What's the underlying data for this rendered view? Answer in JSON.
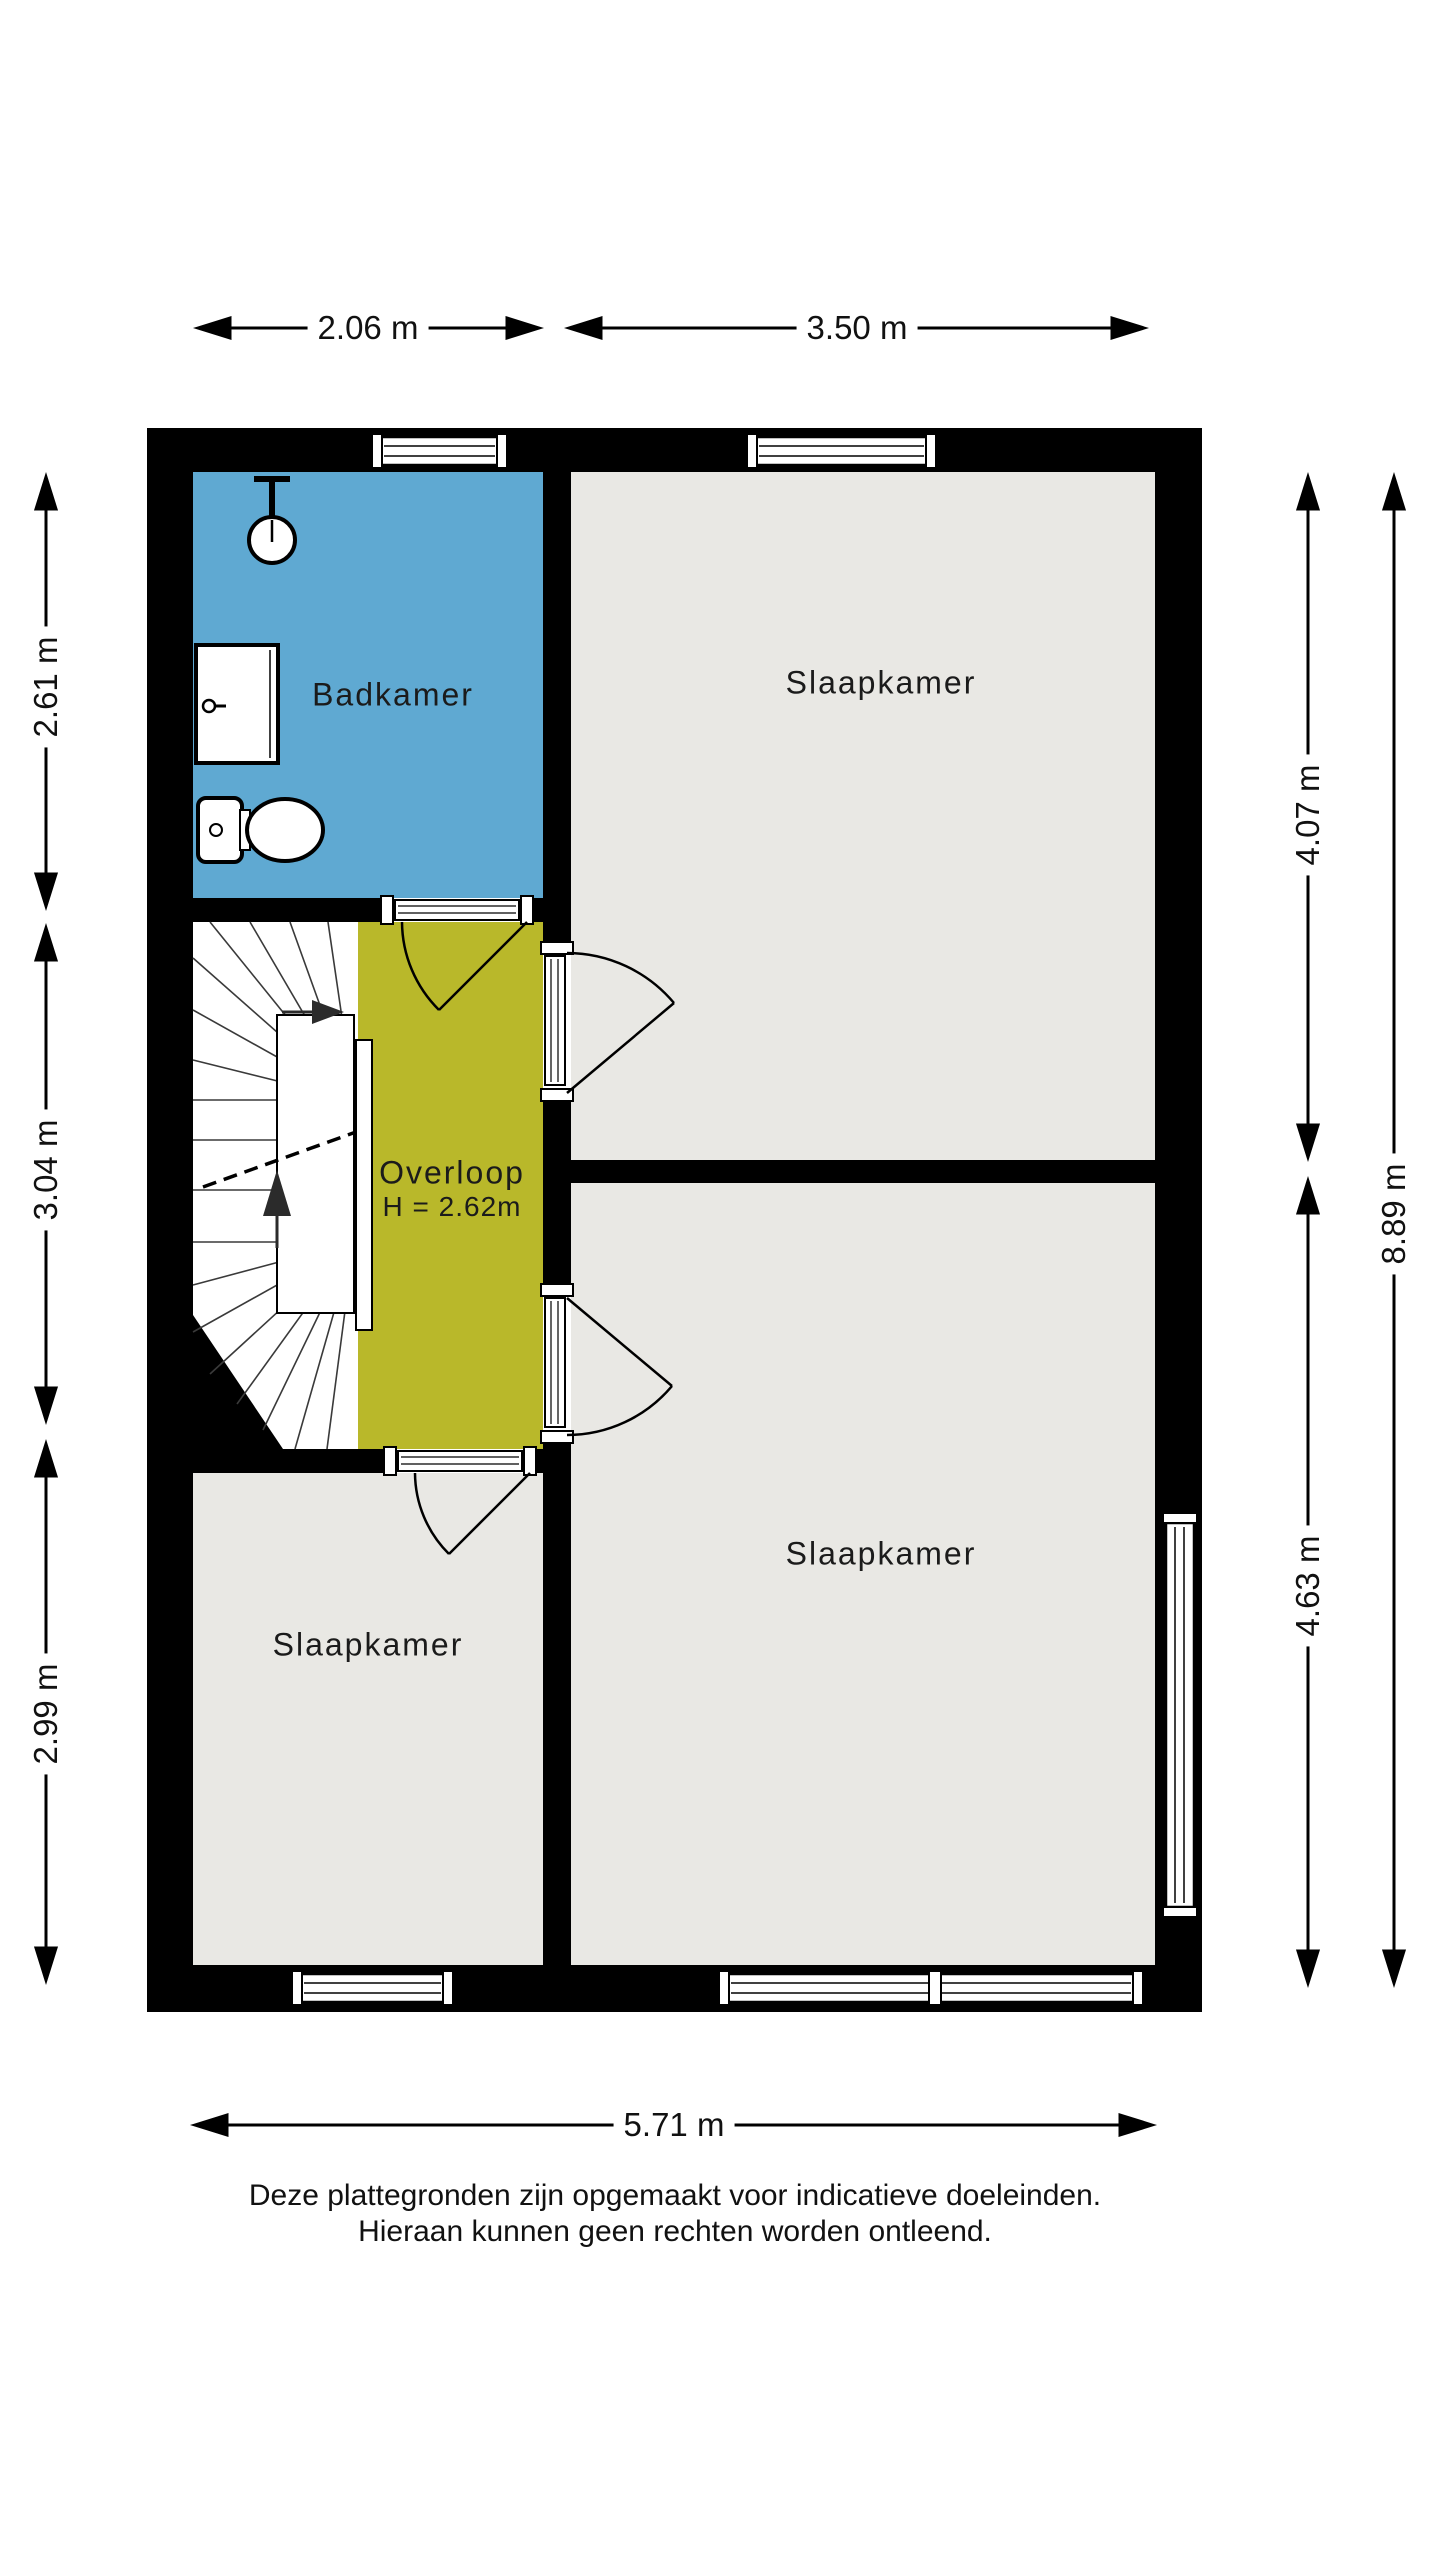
{
  "colors": {
    "wall": "#000000",
    "bathroom_floor": "#5FA9D2",
    "landing_floor": "#B9B82A",
    "room_floor": "#E9E8E4",
    "background": "#FFFFFF",
    "tread_line": "#3a3a3a"
  },
  "rooms": {
    "badkamer": {
      "label": "Badkamer"
    },
    "slaapkamer_top_right": {
      "label": "Slaapkamer"
    },
    "slaapkamer_bottom_right": {
      "label": "Slaapkamer"
    },
    "slaapkamer_bottom_left": {
      "label": "Slaapkamer"
    },
    "overloop": {
      "label": "Overloop",
      "height": "H = 2.62m"
    }
  },
  "dimensions": {
    "top_left_width": "2.06 m",
    "top_right_width": "3.50 m",
    "left_top": "2.61 m",
    "left_middle": "3.04 m",
    "left_bottom": "2.99 m",
    "right_top": "4.07 m",
    "right_bottom": "4.63 m",
    "right_total": "8.89 m",
    "bottom_width": "5.71 m"
  },
  "disclaimer": {
    "line1": "Deze plattegronden zijn opgemaakt voor indicatieve doeleinden.",
    "line2": "Hieraan kunnen geen rechten worden ontleend."
  }
}
